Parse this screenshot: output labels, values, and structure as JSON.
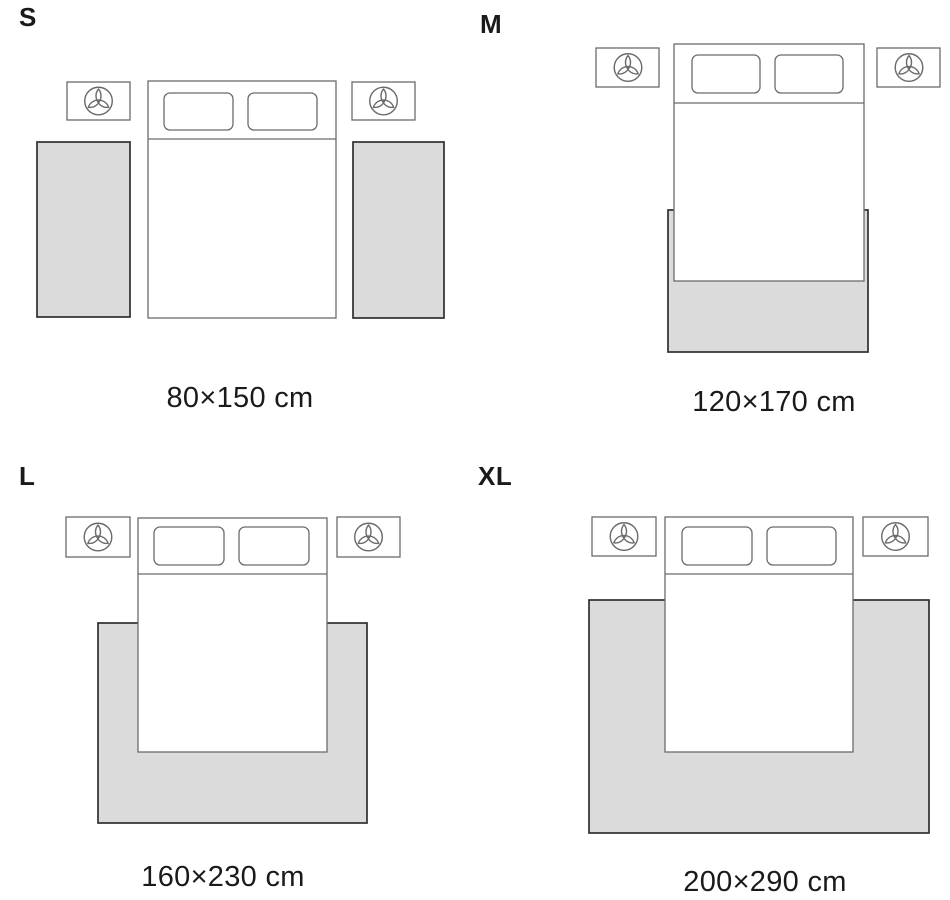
{
  "colors": {
    "page_bg": "#ffffff",
    "text": "#1a1a1a",
    "rug_fill": "#dbdbdb",
    "rug_line": "#2f2f2f",
    "furn_line": "#6b6b6b"
  },
  "icons": {
    "nightstand_decor": "plant-icon"
  },
  "panels": [
    {
      "id": "s",
      "label": "S",
      "caption": "80×150 cm"
    },
    {
      "id": "m",
      "label": "M",
      "caption": "120×170 cm"
    },
    {
      "id": "l",
      "label": "L",
      "caption": "160×230 cm"
    },
    {
      "id": "xl",
      "label": "XL",
      "caption": "200×290 cm"
    }
  ]
}
